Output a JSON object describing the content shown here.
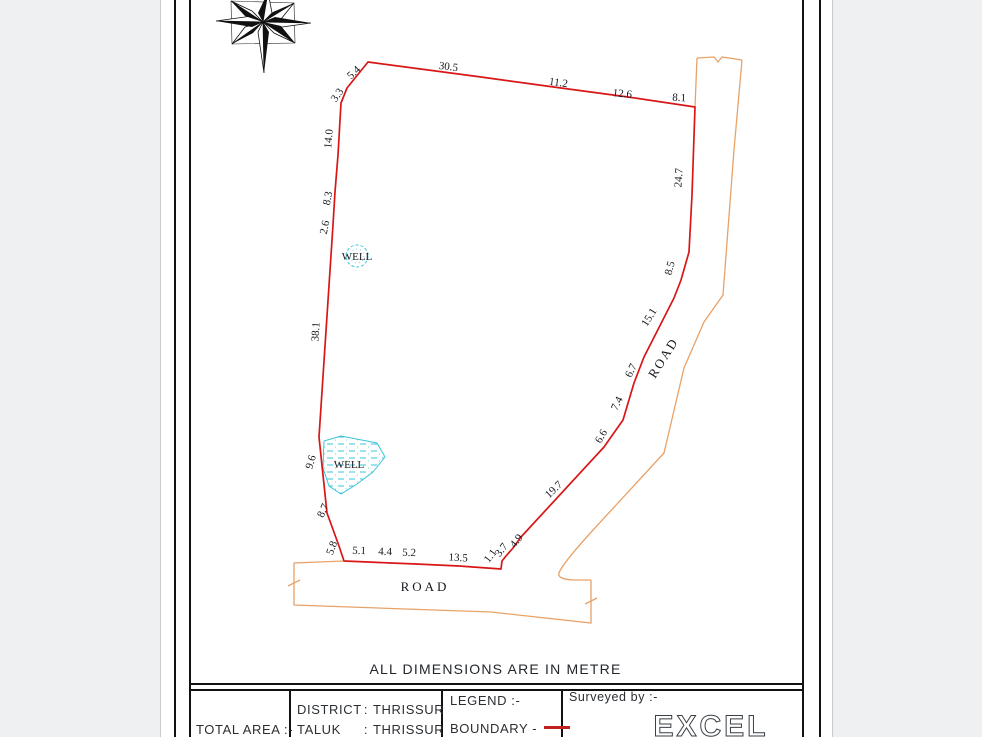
{
  "note": "ALL DIMENSIONS ARE IN METRE",
  "colors": {
    "boundary": "#d81616",
    "road": "#e8a268",
    "well": "#3ac6d8"
  },
  "plan": {
    "dims": [
      "3.3",
      "5.4",
      "30.5",
      "11.2",
      "12.6",
      "8.1",
      "24.7",
      "8.5",
      "15.1",
      "6.7",
      "7.4",
      "6.6",
      "19.7",
      "4.9",
      "3.7",
      "1.1",
      "13.5",
      "5.2",
      "4.4",
      "5.1",
      "5.8",
      "8.7",
      "9.6",
      "38.1",
      "2.6",
      "8.3",
      "14.0"
    ],
    "labels": {
      "well1": "WELL",
      "well2": "WELL",
      "road_right": "ROAD",
      "road_bottom": "ROAD"
    }
  },
  "title_block": {
    "total_area": "TOTAL AREA :-",
    "district_label": "DISTRICT",
    "taluk_label": "TALUK",
    "colon": ":",
    "district_value": "THRISSUR",
    "taluk_value": "THRISSUR",
    "legend": "LEGEND :-",
    "boundary": "BOUNDARY -",
    "surveyed_by": "Surveyed by :-",
    "surveyor_logo": "EXCEL"
  }
}
